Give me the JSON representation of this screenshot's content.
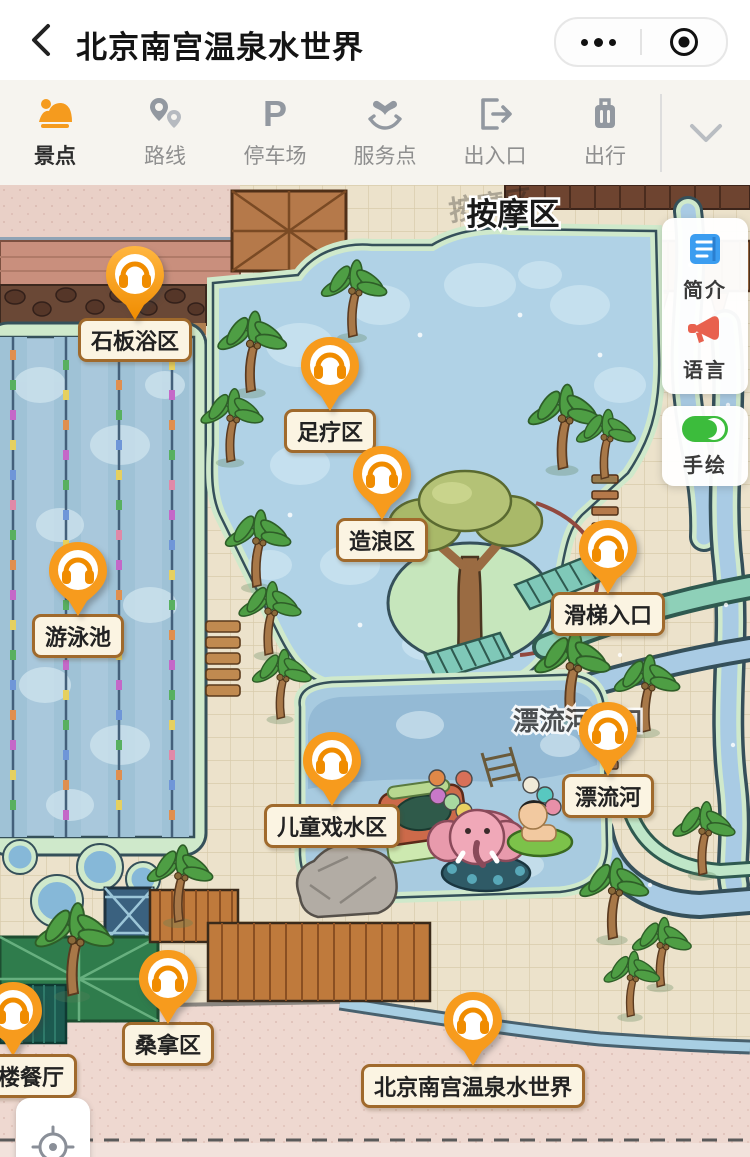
{
  "header": {
    "title": "北京南宫温泉水世界",
    "back_icon": "chevron-left-icon",
    "menu_icon": "more-dots-icon",
    "home_icon": "record-circle-icon"
  },
  "toolbar": {
    "tabs": [
      {
        "label": "景点",
        "icon": "scenic-spot-icon",
        "active": true
      },
      {
        "label": "路线",
        "icon": "route-pins-icon",
        "active": false
      },
      {
        "label": "停车场",
        "icon": "parking-icon",
        "active": false
      },
      {
        "label": "服务点",
        "icon": "service-heart-icon",
        "active": false
      },
      {
        "label": "出入口",
        "icon": "exit-entrance-icon",
        "active": false
      },
      {
        "label": "出行",
        "icon": "luggage-icon",
        "active": false
      }
    ],
    "collapse_icon": "chevron-down-icon"
  },
  "side_panel": {
    "intro_label": "简介",
    "language_label": "语言",
    "handdrawn_label": "手绘",
    "handdrawn_toggle_state": "on"
  },
  "map": {
    "area_labels": [
      {
        "text": "按摩区"
      },
      {
        "text": "漂流河入口"
      }
    ],
    "markers": [
      {
        "label": "石板浴区"
      },
      {
        "label": "足疗区"
      },
      {
        "label": "造浪区"
      },
      {
        "label": "游泳池"
      },
      {
        "label": "滑梯入口"
      },
      {
        "label": "漂流河"
      },
      {
        "label": "儿童戏水区"
      },
      {
        "label": "桑拿区"
      },
      {
        "label": "楼餐厅"
      },
      {
        "label": "北京南宫温泉水世界"
      }
    ],
    "locate_icon": "crosshair-locate-icon"
  },
  "colors": {
    "accent_orange": "#f59b1e",
    "label_border": "#a06a2c",
    "intro_blue": "#3b9df0",
    "megaphone_red": "#e8614e",
    "toggle_green": "#3cbc3c",
    "pool_blue": "#aecfe3",
    "rim_green": "#cfe9cb",
    "promenade_pink": "#eed8d0",
    "ground_tan": "#ece2cb"
  }
}
